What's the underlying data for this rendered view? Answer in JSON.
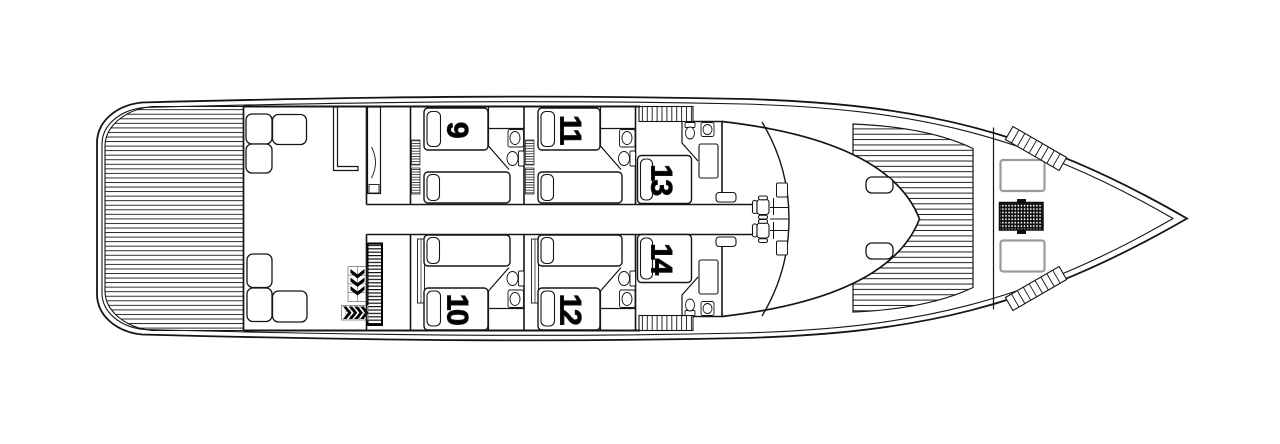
{
  "diagram": {
    "title": "yacht-lower-deck-plan",
    "cabins": [
      {
        "number": "9",
        "bed_type": "twin"
      },
      {
        "number": "10",
        "bed_type": "twin"
      },
      {
        "number": "11",
        "bed_type": "twin"
      },
      {
        "number": "12",
        "bed_type": "twin"
      },
      {
        "number": "13",
        "bed_type": "double"
      },
      {
        "number": "14",
        "bed_type": "double"
      }
    ],
    "colors": {
      "line": "#151515",
      "paper": "#ffffff",
      "sunpad_border": "#9a9a9a",
      "grate_fill": "#0d0d0d"
    }
  }
}
